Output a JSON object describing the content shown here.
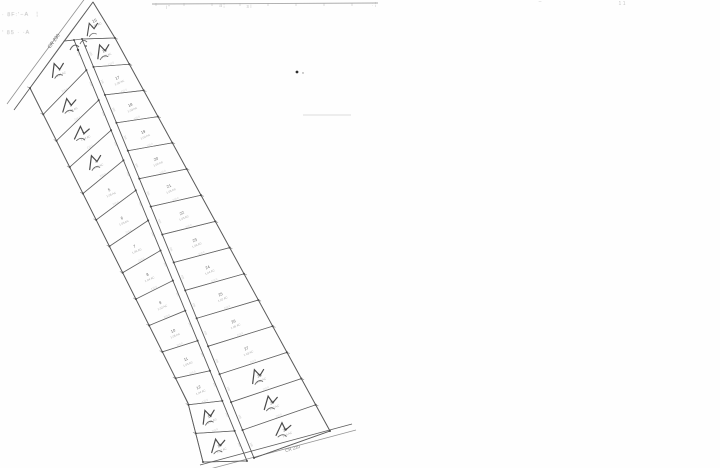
{
  "document": {
    "type": "scanned-subdivision-plat",
    "background": "#fefefe"
  },
  "stamp": {
    "line1": "· 8F:'−A   ¦",
    "line2": "' 85 · ·A"
  },
  "top_border": {
    "x1": 152,
    "y1": 4,
    "x2": 378,
    "y2": 3,
    "fragments": [
      {
        "x": 168,
        "y": 9,
        "t": "i ''"
      },
      {
        "x": 222,
        "y": 7,
        "t": "a ¦"
      },
      {
        "x": 249,
        "y": 8,
        "t": "s i"
      },
      {
        "x": 374,
        "y": 6,
        "t": ": ¦"
      },
      {
        "x": 540,
        "y": 3,
        "t": "–"
      },
      {
        "x": 622,
        "y": 5,
        "t": "1 1"
      }
    ]
  },
  "artifacts": {
    "specks": [
      {
        "x": 297,
        "y": 72,
        "r": 1.4,
        "c": "#2f2f2f"
      },
      {
        "x": 303,
        "y": 73,
        "r": 0.7,
        "c": "#8a8a8a"
      }
    ],
    "faint_line": {
      "x1": 303,
      "y1": 115,
      "x2": 351,
      "y2": 115
    }
  },
  "plat": {
    "ink": "#4a4a4a",
    "lot_ink": "#606060",
    "micro_ink": "#8c8c8c",
    "hand_ink": "#2b2b2b",
    "roads": {
      "cr230": {
        "label": "CR 230",
        "label_x": 55,
        "label_y": 42,
        "label_rot": -53,
        "near": [
          [
            93,
            2
          ],
          [
            30,
            88
          ],
          [
            14,
            110
          ]
        ],
        "far": [
          [
            86,
            -3
          ],
          [
            23,
            82
          ],
          [
            7,
            104
          ]
        ]
      },
      "cr220": {
        "label": "CR 220",
        "label_x": 293,
        "label_y": 450,
        "label_rot": -17,
        "upper": [
          [
            200,
            465
          ],
          [
            352,
            424
          ]
        ],
        "lower": [
          [
            206,
            470
          ],
          [
            356,
            430
          ]
        ]
      },
      "central": {
        "left": [
          [
            74,
            40
          ],
          [
            247,
            461
          ]
        ],
        "right": [
          [
            82,
            39
          ],
          [
            254,
            458
          ]
        ]
      }
    },
    "geometry": {
      "apex_pt": [
        93,
        2
      ],
      "p_left": [
        64,
        41
      ],
      "q_right": [
        115,
        38
      ],
      "west": [
        30,
        88
      ],
      "left_kink": [
        188,
        403
      ],
      "left_end": [
        203,
        462
      ],
      "se": [
        330,
        431
      ],
      "frontage_text": "105",
      "depth_text": "210.0",
      "lot_text_rot": -24,
      "road_text_rot": 67
    },
    "apex_lot": {
      "n": "15",
      "a": "0.52 AC",
      "mark": true
    },
    "left_lots": [
      {
        "n": "1",
        "a": "1.21 AC",
        "mark": true
      },
      {
        "n": "2",
        "a": "1.08 AC",
        "mark": true
      },
      {
        "n": "3",
        "a": "1.04 AC",
        "mark": true
      },
      {
        "n": "4",
        "a": "1.02 AC",
        "mark": true
      },
      {
        "n": "5",
        "a": "1.05 AC",
        "mark": false
      },
      {
        "n": "6",
        "a": "1.03 AC",
        "mark": false
      },
      {
        "n": "7",
        "a": "1.06 AC",
        "mark": false
      },
      {
        "n": "8",
        "a": "1.04 AC",
        "mark": false
      },
      {
        "n": "9",
        "a": "1.02 AC",
        "mark": false
      },
      {
        "n": "10",
        "a": "1.05 AC",
        "mark": false
      },
      {
        "n": "11",
        "a": "1.03 AC",
        "mark": false
      },
      {
        "n": "12",
        "a": "1.04 AC",
        "mark": false
      },
      {
        "n": "13",
        "a": "1.06 AC",
        "mark": true
      },
      {
        "n": "14",
        "a": "1.12 AC",
        "mark": true
      }
    ],
    "right_lots": [
      {
        "n": "16",
        "a": "1.09 AC",
        "mark": true
      },
      {
        "n": "17",
        "a": "1.05 AC",
        "mark": false
      },
      {
        "n": "18",
        "a": "1.03 AC",
        "mark": false
      },
      {
        "n": "19",
        "a": "1.04 AC",
        "mark": false
      },
      {
        "n": "20",
        "a": "1.02 AC",
        "mark": false
      },
      {
        "n": "21",
        "a": "1.05 AC",
        "mark": false
      },
      {
        "n": "22",
        "a": "1.03 AC",
        "mark": false
      },
      {
        "n": "23",
        "a": "1.06 AC",
        "mark": false
      },
      {
        "n": "24",
        "a": "1.04 AC",
        "mark": false
      },
      {
        "n": "25",
        "a": "1.02 AC",
        "mark": false
      },
      {
        "n": "26",
        "a": "1.05 AC",
        "mark": false
      },
      {
        "n": "27",
        "a": "1.03 AC",
        "mark": false
      },
      {
        "n": "28",
        "a": "1.04 AC",
        "mark": true
      },
      {
        "n": "29",
        "a": "1.07 AC",
        "mark": true
      },
      {
        "n": "30",
        "a": "1.14 AC",
        "mark": true
      }
    ]
  }
}
